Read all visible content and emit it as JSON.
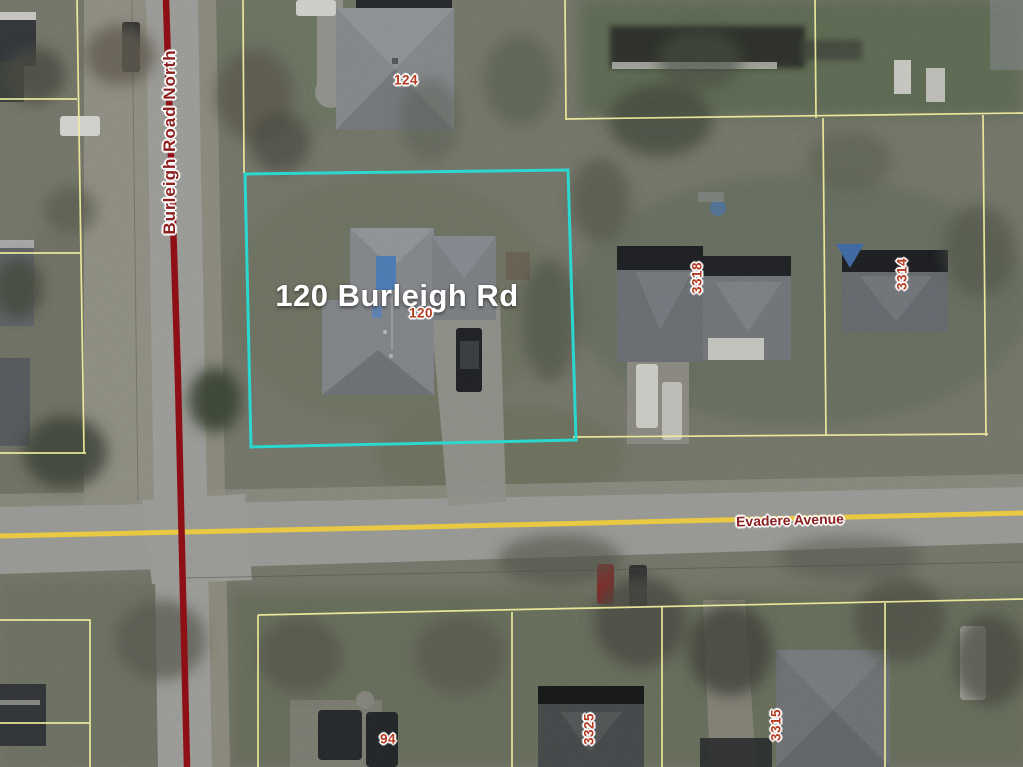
{
  "colors": {
    "highlight": "#2bd8cf",
    "parcel_line": "#efec9e",
    "road_center_red": "#8e1016",
    "road_center_yellow": "#e9c843",
    "number_label": "#b53a20",
    "street_label": "#8c2020",
    "address_label": "#ffffff"
  },
  "labels": {
    "address": "120 Burleigh Rd",
    "street_vertical": "Burleigh Road North",
    "street_horizontal": "Evadere Avenue",
    "parcel_numbers": {
      "p124": "124",
      "p120": "120",
      "p3318": "3318",
      "p3314": "3314",
      "p94": "94",
      "p3325": "3325",
      "p3315": "3315"
    }
  }
}
